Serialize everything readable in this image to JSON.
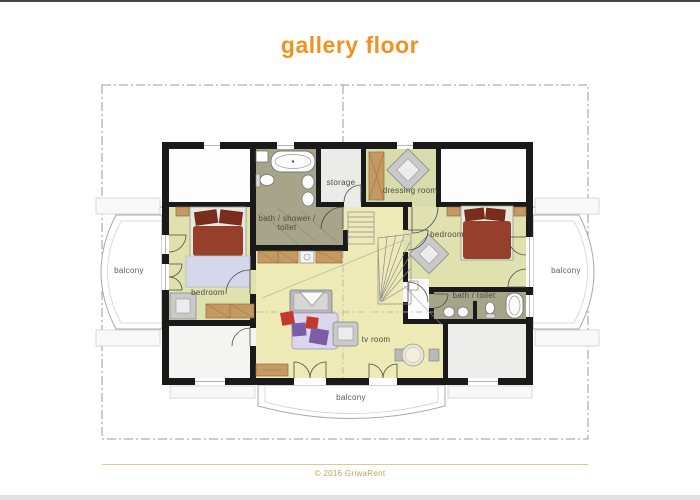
{
  "page": {
    "title": "gallery floor"
  },
  "footer": {
    "copyright": "© 2016 GriwaRent"
  },
  "colors": {
    "accent_orange": "#f0921e",
    "footer_gold": "#bfa05a",
    "wall_black": "#1a1a1a",
    "bedroom_green": "#dfe1ae",
    "dressing_green": "#d8dcac",
    "hall_yellow": "#edeab6",
    "bath_olive": "#a6a489",
    "storage_grey": "#ebebe9",
    "bed_red": "#96402b",
    "pillow_red": "#7a2d1c",
    "blanket_lavender": "#d5d8ea",
    "sofa_lilac": "#dcd6ec",
    "pillow_purple": "#7b5ca6",
    "cushion_red": "#c33a2c",
    "wood_tan": "#c59a62",
    "outline_grey": "#9a9a9a"
  },
  "rooms": {
    "balcony_left": {
      "label": "balcony"
    },
    "balcony_right": {
      "label": "balcony"
    },
    "balcony_bottom": {
      "label": "balcony"
    },
    "bedroom_left": {
      "label": "bedroom"
    },
    "bedroom_right": {
      "label": "bedroom"
    },
    "storage": {
      "label": "storage"
    },
    "dressing_room": {
      "label": "dressing room"
    },
    "bath_shower_toilet": {
      "label": "bath / shower / toilet"
    },
    "bath_toilet": {
      "label": "bath / toilet"
    },
    "tv_room": {
      "label": "tv room"
    }
  }
}
